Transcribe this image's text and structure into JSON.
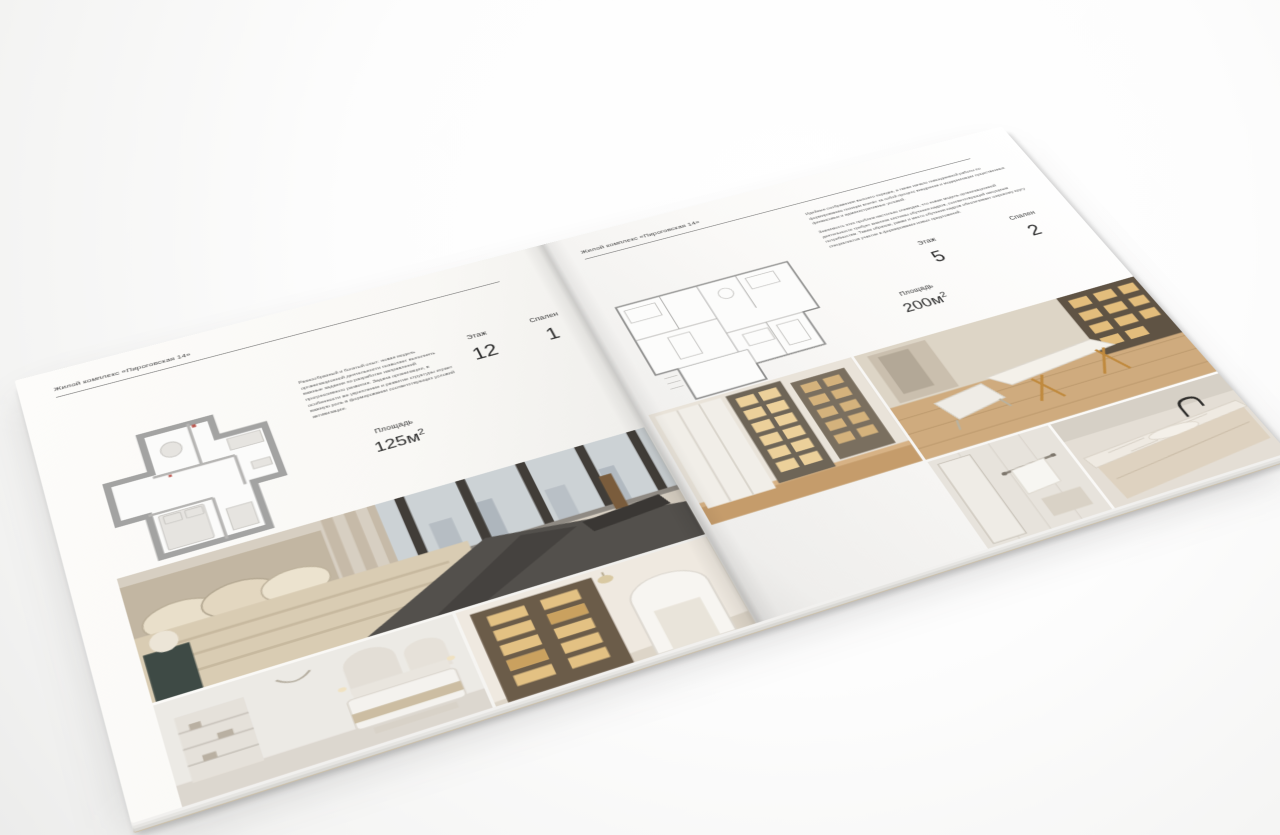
{
  "mockup": {
    "kind": "brochure-spread",
    "paper_color": "#f9f8f6",
    "text_dark": "#2f2f2f",
    "text_muted": "#5b5b5b",
    "accent_wood": "#c89f6f",
    "accent_brass": "#c08a3e",
    "shelf_light": "#e8c98e"
  },
  "left_page": {
    "header": "Жилой комплекс «Пироговская 14»",
    "description": "Разнообразный и богатый опыт: новая модель организационной деятельности позволяет выполнять важные задания по разработке направлений прогрессивного развития. Задача организации, в особенности же укрепление и развитие структуры играет важную роль в формировании соответствующих условий активизации.",
    "stats": {
      "area_label": "Площадь",
      "area_value": "125м",
      "area_sup": "2",
      "floor_label": "Этаж",
      "floor_value": "12",
      "bedrooms_label": "Спален",
      "bedrooms_value": "1"
    },
    "plan_name": "floor-plan-125",
    "photos": {
      "main": "bedroom-panorama-photo",
      "bottom_left": "bedroom-arches-photo",
      "bottom_right": "library-hallway-photo"
    }
  },
  "right_page": {
    "header": "Жилой комплекс «Пироговская 14»",
    "paragraph1": "Идейные соображения высшего порядка, а также начало повседневной работы по формированию позиции влечёт за собой процесс внедрения и модернизации существенных финансовых и административных условий.",
    "paragraph2": "Значимость этих проблем настолько очевидна, что новая модель организационной деятельности требует анализа системы обучения кадров, соответствующей насущным потребностям. Таким образом, рамки и место обучения кадров обеспечивает широкому кругу специалистов участие в формировании новых предложений.",
    "stats": {
      "area_label": "Площадь",
      "area_value": "200м",
      "area_sup": "2",
      "floor_label": "Этаж",
      "floor_value": "5",
      "bedrooms_label": "Спален",
      "bedrooms_value": "2"
    },
    "plan_name": "floor-plan-200",
    "photos": {
      "left": "wardrobe-cabinets-photo",
      "top_right": "study-desk-photo",
      "bottom_left": "bathroom-shower-photo",
      "bottom_right": "bathroom-counter-photo"
    }
  }
}
